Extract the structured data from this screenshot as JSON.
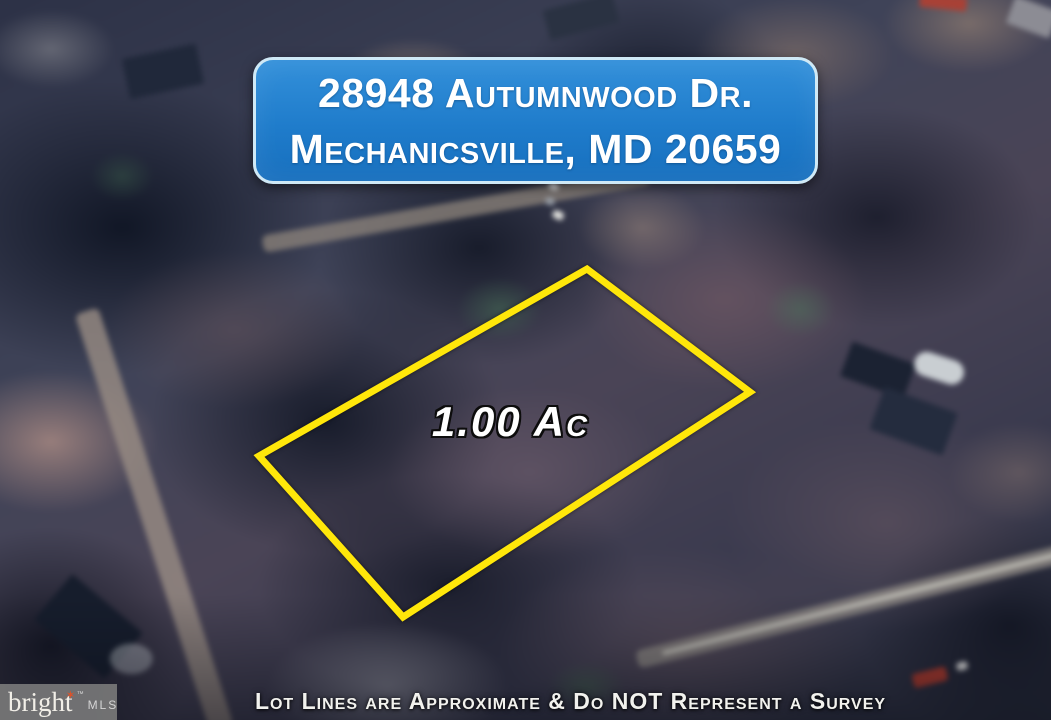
{
  "address_banner": {
    "line1": "28948 Autumnwood Dr.",
    "line2": "Mechanicsville, MD 20659",
    "background_color": "#1f7ccb",
    "border_color": "#cfe9f6",
    "text_color": "#ffffff"
  },
  "lot": {
    "area_label": "1.00 Ac",
    "outline_color": "#ffe70a",
    "polygon_points": "587,269 750,392 403,617 259,456"
  },
  "watermark": {
    "brand": "bright",
    "star_icon": "✶",
    "trademark": "™",
    "suffix": "MLS",
    "star_color": "#d9532b"
  },
  "disclaimer": "Lot Lines are Approximate & Do NOT Represent a Survey"
}
